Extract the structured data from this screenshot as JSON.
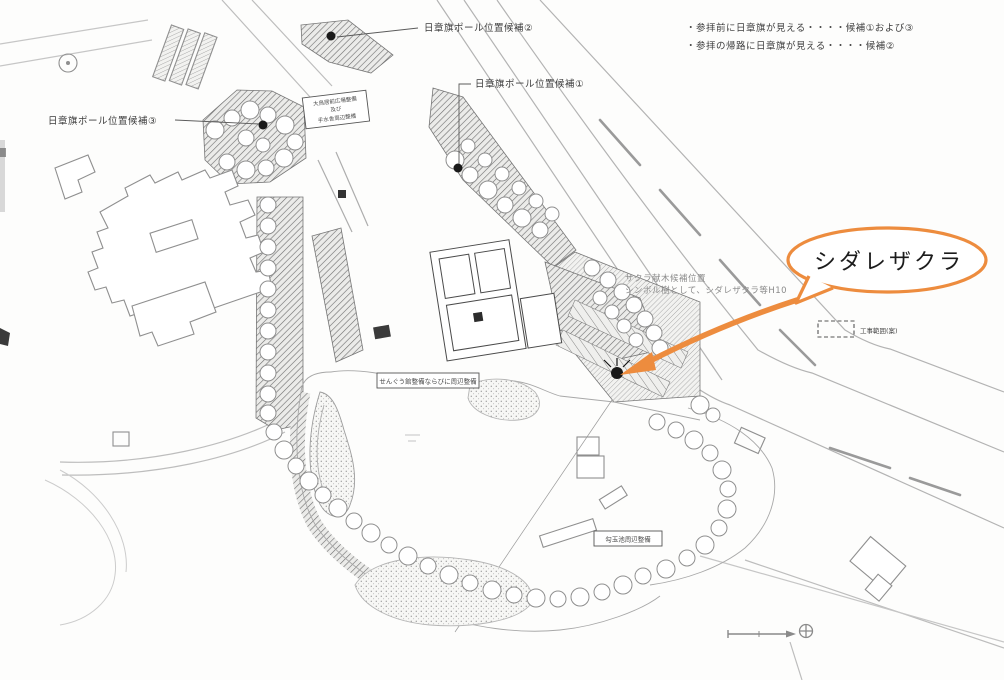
{
  "map": {
    "labels": {
      "flag_pole_1": "日章旗ポール位置候補①",
      "flag_pole_2": "日章旗ポール位置候補②",
      "flag_pole_3": "日章旗ポール位置候補③"
    },
    "notes": {
      "line1": "・参拝前に日章旗が見える・・・・候補①および③",
      "line2": "・参拝の帰路に日章旗が見える・・・・候補②"
    },
    "sakura_note": {
      "line1": "サクラ献木候補位置",
      "line2": "シンボル樹として、シダレザクラ等H10"
    },
    "callout": {
      "label": "シダレザクラ",
      "accent_color": "#ED8C3E"
    },
    "area_boxes": {
      "otorii": {
        "line1": "大鳥居前広場整備",
        "line2": "及び",
        "line3": "手水舎周辺整備"
      },
      "sengukan": "せんぐう館整備ならびに周辺整備",
      "magatama": "勾玉池周辺整備"
    },
    "legend": {
      "construction_area": "工事範囲(案)"
    }
  }
}
